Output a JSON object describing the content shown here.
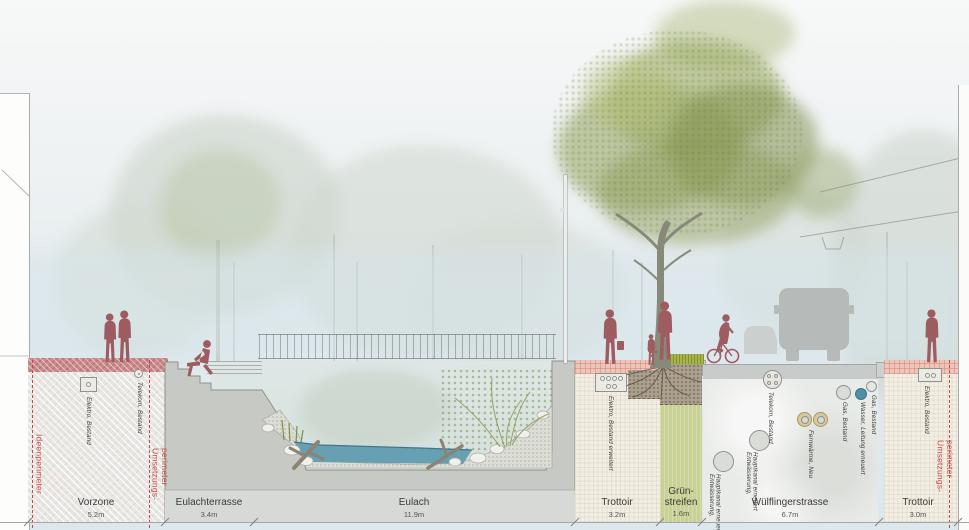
{
  "zones": [
    {
      "name": "Vorzone",
      "dim": "5.2m"
    },
    {
      "name": "Eulachterrasse",
      "dim": "3.4m"
    },
    {
      "name": "Eulach",
      "dim": "11.9m"
    },
    {
      "name": "Trottoir",
      "dim": "3.2m"
    },
    {
      "name": "Grün-streifen",
      "dim": "1.6m"
    },
    {
      "name": "Wülflingerstrasse",
      "dim": "6.7m"
    },
    {
      "name": "Trottoir",
      "dim": "3.0m"
    }
  ],
  "perimeter": {
    "left": "Ideenperimeter",
    "middle": "Umsetzungs-perimeter",
    "right": "Umsetzungs-perimeter"
  },
  "utilities": [
    {
      "id": "elektro-vorzone",
      "label": "Elektro, Bestand",
      "icon": "conduit-box-icon"
    },
    {
      "id": "telekom-vorzone",
      "label": "Telekom, Bestand",
      "icon": "pipe-circle-icon"
    },
    {
      "id": "elektro-trottoir",
      "label": "Elektro, Bestand erweitert",
      "icon": "conduit-box-6-icon"
    },
    {
      "id": "telekom-strasse",
      "label": "Telekom, Bestand",
      "icon": "conduit-circle-icon"
    },
    {
      "id": "gas-strasse",
      "label": "Gas, Bestand",
      "icon": "pipe-circle-icon"
    },
    {
      "id": "wasser-strasse",
      "label": "Wasser, Leitung erneuert",
      "icon": "pipe-circle-filled-icon"
    },
    {
      "id": "gas-strasse-2",
      "label": "Gas, Bestand",
      "icon": "pipe-circle-icon"
    },
    {
      "id": "fernwaerme",
      "label": "Fernwärme, Neu",
      "icon": "double-pipe-icon"
    },
    {
      "id": "entwaesserung-1",
      "label": "Entwässerung, Hauptkanal erneuert",
      "icon": "main-pipe-icon"
    },
    {
      "id": "entwaesserung-2",
      "label": "Entwässerung, Hauptkanal erneuert",
      "icon": "main-pipe-icon"
    },
    {
      "id": "elektro-trottoir-rechts",
      "label": "Elektro, Bestand",
      "icon": "conduit-box-2-icon"
    }
  ],
  "colors": {
    "perimeter_red": "#c2494e",
    "surface_red": "#c98a8c",
    "surface_pink": "#ecc5bb",
    "water": "#68a0b3",
    "canopy_green": "#93a35c",
    "figure_red": "#9c5c60",
    "concrete": "#c6c9c4",
    "wasser_pipe": "#4e91a5",
    "fernwaerme_ring": "#d9c89b"
  }
}
